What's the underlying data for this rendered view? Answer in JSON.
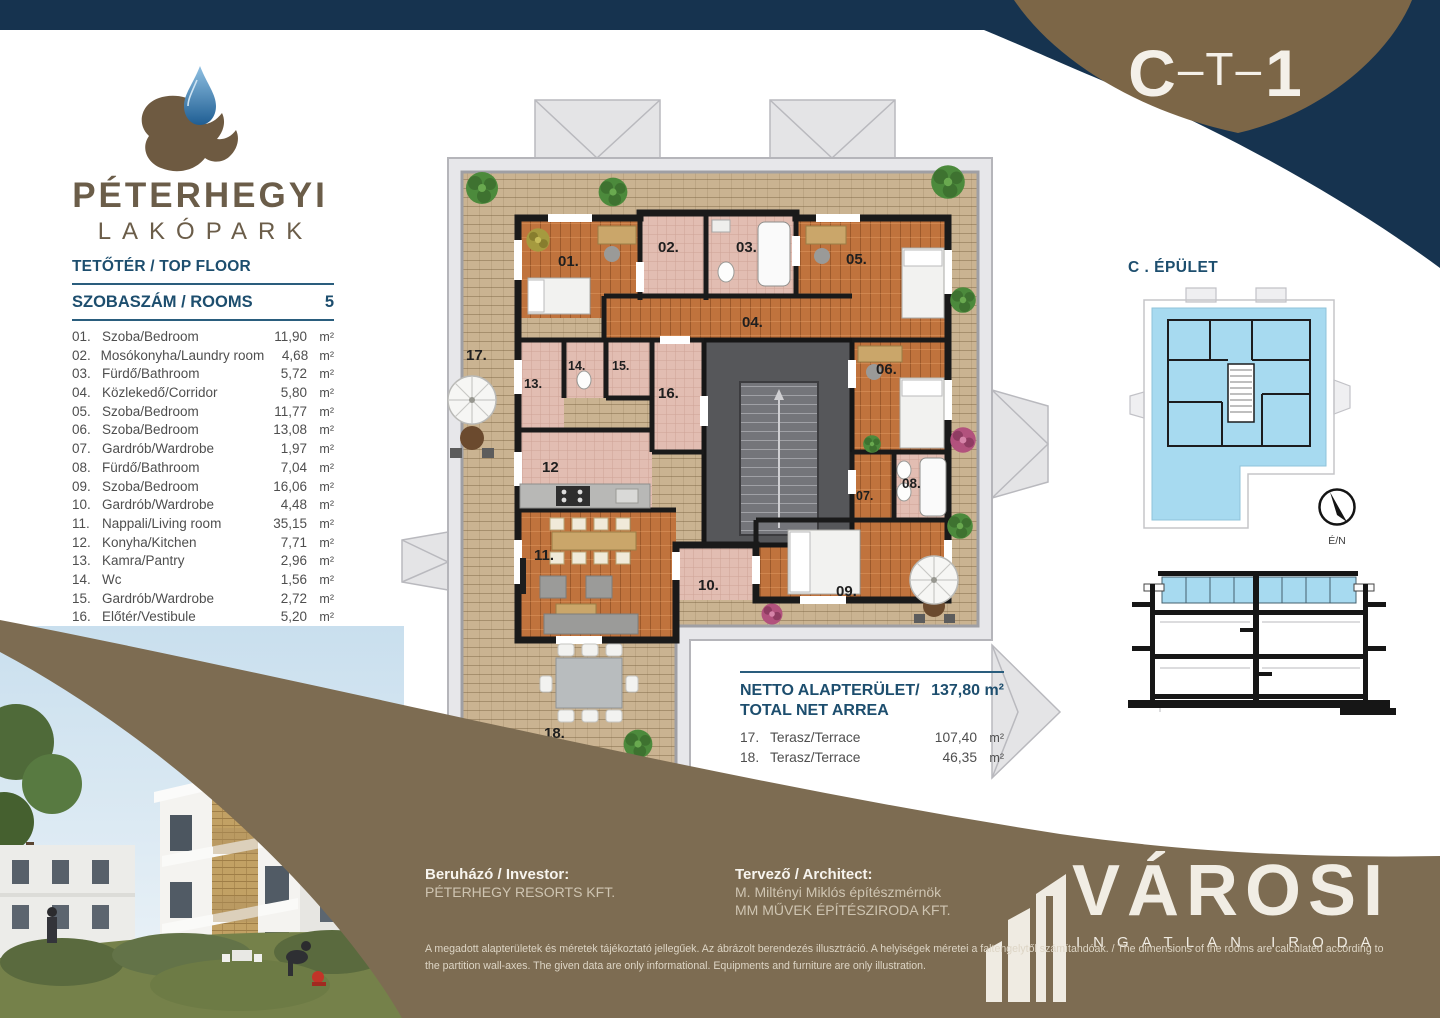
{
  "unit_code": {
    "part1": "C",
    "middle": "–T–",
    "part3": "1"
  },
  "logo": {
    "name_line1": "PÉTERHEGYI",
    "name_line2": "LAKÓPARK"
  },
  "room_list": {
    "floor_heading": "TETŐTÉR / TOP FLOOR",
    "rooms_heading": "SZOBASZÁM / ROOMS",
    "rooms_count": "5",
    "unit": "m²",
    "rooms": [
      {
        "num": "01.",
        "name": "Szoba/Bedroom",
        "area": "11,90"
      },
      {
        "num": "02.",
        "name": "Mosókonyha/Laundry room",
        "area": "4,68"
      },
      {
        "num": "03.",
        "name": "Fürdő/Bathroom",
        "area": "5,72"
      },
      {
        "num": "04.",
        "name": "Közlekedő/Corridor",
        "area": "5,80"
      },
      {
        "num": "05.",
        "name": "Szoba/Bedroom",
        "area": "11,77"
      },
      {
        "num": "06.",
        "name": "Szoba/Bedroom",
        "area": "13,08"
      },
      {
        "num": "07.",
        "name": "Gardrób/Wardrobe",
        "area": "1,97"
      },
      {
        "num": "08.",
        "name": "Fürdő/Bathroom",
        "area": "7,04"
      },
      {
        "num": "09.",
        "name": "Szoba/Bedroom",
        "area": "16,06"
      },
      {
        "num": "10.",
        "name": "Gardrób/Wardrobe",
        "area": "4,48"
      },
      {
        "num": "11.",
        "name": "Nappali/Living room",
        "area": "35,15"
      },
      {
        "num": "12.",
        "name": "Konyha/Kitchen",
        "area": "7,71"
      },
      {
        "num": "13.",
        "name": "Kamra/Pantry",
        "area": "2,96"
      },
      {
        "num": "14.",
        "name": "Wc",
        "area": "1,56"
      },
      {
        "num": "15.",
        "name": "Gardrób/Wardrobe",
        "area": "2,72"
      },
      {
        "num": "16.",
        "name": "Előtér/Vestibule",
        "area": "5,20"
      }
    ]
  },
  "net_area": {
    "title_line1": "NETTO ALAPTERÜLET/",
    "title_line2": "TOTAL NET ARREA",
    "total": "137,80 m²",
    "unit": "m²",
    "items": [
      {
        "num": "17.",
        "name": "Terasz/Terrace",
        "area": "107,40"
      },
      {
        "num": "18.",
        "name": "Terasz/Terrace",
        "area": "46,35"
      }
    ]
  },
  "right_panel": {
    "building_heading": "C . ÉPÜLET",
    "compass_label": "É/N"
  },
  "plan_labels": {
    "r01": "01.",
    "r02": "02.",
    "r03": "03.",
    "r04": "04.",
    "r05": "05.",
    "r06": "06.",
    "r07": "07.",
    "r08": "08.",
    "r09": "09.",
    "r10": "10.",
    "r11": "11.",
    "r12": "12",
    "r13": "13.",
    "r14": "14.",
    "r15": "15.",
    "r16": "16.",
    "r17": "17.",
    "r18": "18."
  },
  "footer": {
    "investor_label": "Beruházó / Investor:",
    "investor_name": "PÉTERHEGY RESORTS KFT.",
    "architect_label": "Tervező / Architect:",
    "architect_name": "M. Miltényi Miklós építészmérnök",
    "architect_company": "MM MŰVEK ÉPÍTÉSZIRODA KFT.",
    "disclaimer_line1": "A megadott alapterületek és méretek tájékoztató jellegűek. Az ábrázolt berendezés illusztráció. A helyiségek méretei a faltengelytől számítandóak. / The dimensions of the rooms are calculated according to",
    "disclaimer_line2": "the partition wall-axes. The given data are only informational. Equipments and furniture are only illustration.",
    "brand_name": "VÁROSI",
    "brand_subtitle": "INGATLAN IRODA"
  },
  "colors": {
    "navy": "#16334f",
    "header_brown": "#7c6647",
    "footer_brown": "#7d6c52",
    "heading_blue": "#1d4e6e",
    "plan_highlight_blue": "#a7daf0",
    "terrace_wood": "#cab391",
    "room_wood": "#c0733d",
    "room_tile": "#e2bdb2",
    "logo_brown": "#6b5d49"
  }
}
